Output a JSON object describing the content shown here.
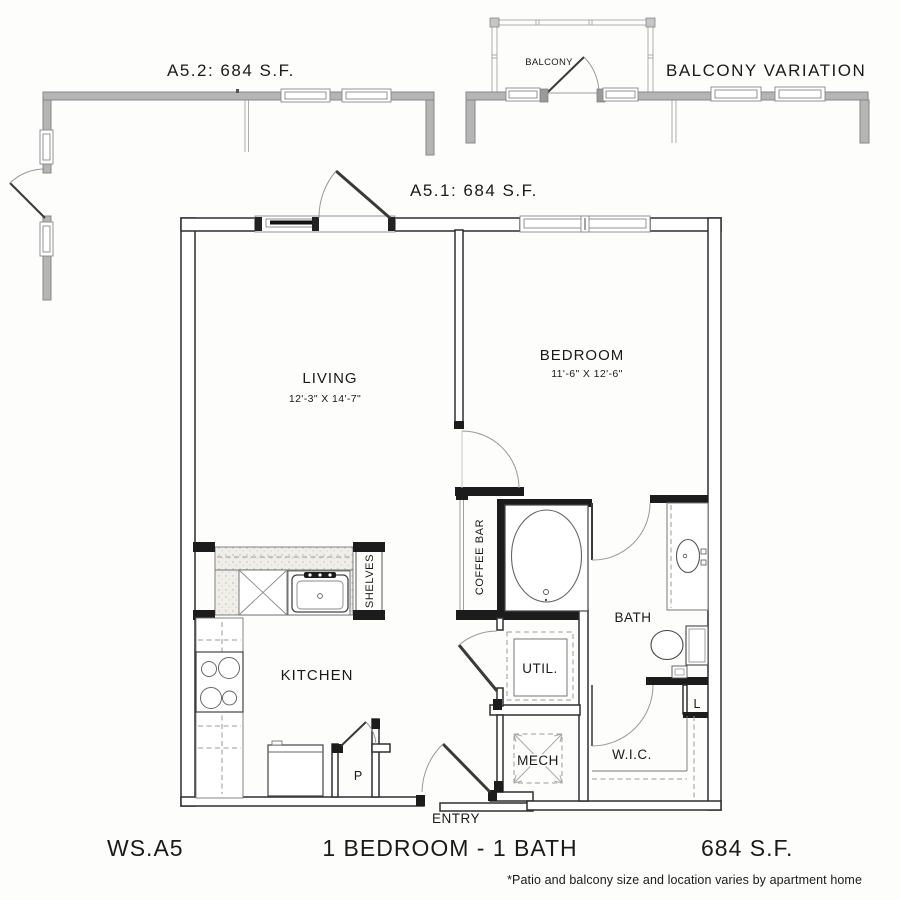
{
  "variations": {
    "a52_label": "A5.2: 684 S.F.",
    "balcony_variation_label": "BALCONY VARIATION",
    "balcony_room_label": "BALCONY",
    "a51_label": "A5.1: 684 S.F."
  },
  "rooms": {
    "living": {
      "label": "LIVING",
      "dims": "12'-3\" X 14'-7\""
    },
    "bedroom": {
      "label": "BEDROOM",
      "dims": "11'-6\" X 12'-6\""
    },
    "kitchen": {
      "label": "KITCHEN"
    },
    "bath": {
      "label": "BATH"
    },
    "utility": {
      "label": "UTIL."
    },
    "mechanical": {
      "label": "MECH"
    },
    "walk_in_closet": {
      "label": "W.I.C."
    },
    "coffee_bar": {
      "label": "COFFEE BAR"
    },
    "shelves": {
      "label": "SHELVES"
    },
    "linen": {
      "label": "L"
    },
    "pantry": {
      "label": "P"
    },
    "entry": {
      "label": "ENTRY"
    }
  },
  "footer": {
    "plan_code": "WS.A5",
    "plan_title": "1 BEDROOM - 1 BATH",
    "plan_area": "684 S.F.",
    "disclaimer": "*Patio and balcony size and location varies by apartment home"
  },
  "colors": {
    "patio_wall_gray": "#b5b5b5",
    "interior_wall_dark": "#1c1c1c",
    "line_color": "#333333",
    "text_color": "#1a1a1a"
  }
}
